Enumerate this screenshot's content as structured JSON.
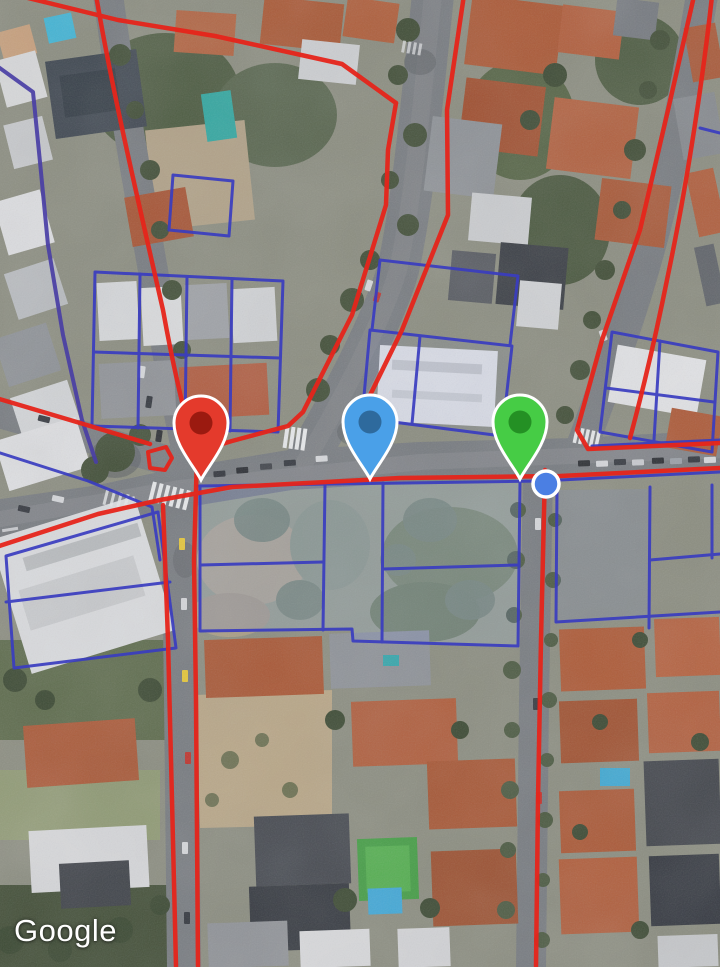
{
  "map": {
    "provider_watermark": "Google",
    "imagery_type": "satellite",
    "overlay": {
      "boundary_color_primary": "#e6251b",
      "parcel_color": "#3a3dc0",
      "parcel_tint_color": "rgba(125,145,215,0.20)"
    },
    "markers": [
      {
        "id": "red-pin",
        "type": "pin",
        "color": "#e43a2c",
        "inner_color": "#8e150c",
        "x": 201,
        "y": 424
      },
      {
        "id": "blue-pin",
        "type": "pin",
        "color": "#4aa0e8",
        "inner_color": "#29608f",
        "x": 370,
        "y": 423
      },
      {
        "id": "green-pin",
        "type": "pin",
        "color": "#46cc45",
        "inner_color": "#1f851f",
        "x": 520,
        "y": 423
      },
      {
        "id": "blue-dot",
        "type": "dot",
        "color": "#4b7fe3",
        "x": 546,
        "y": 484,
        "radius": 13
      }
    ]
  }
}
